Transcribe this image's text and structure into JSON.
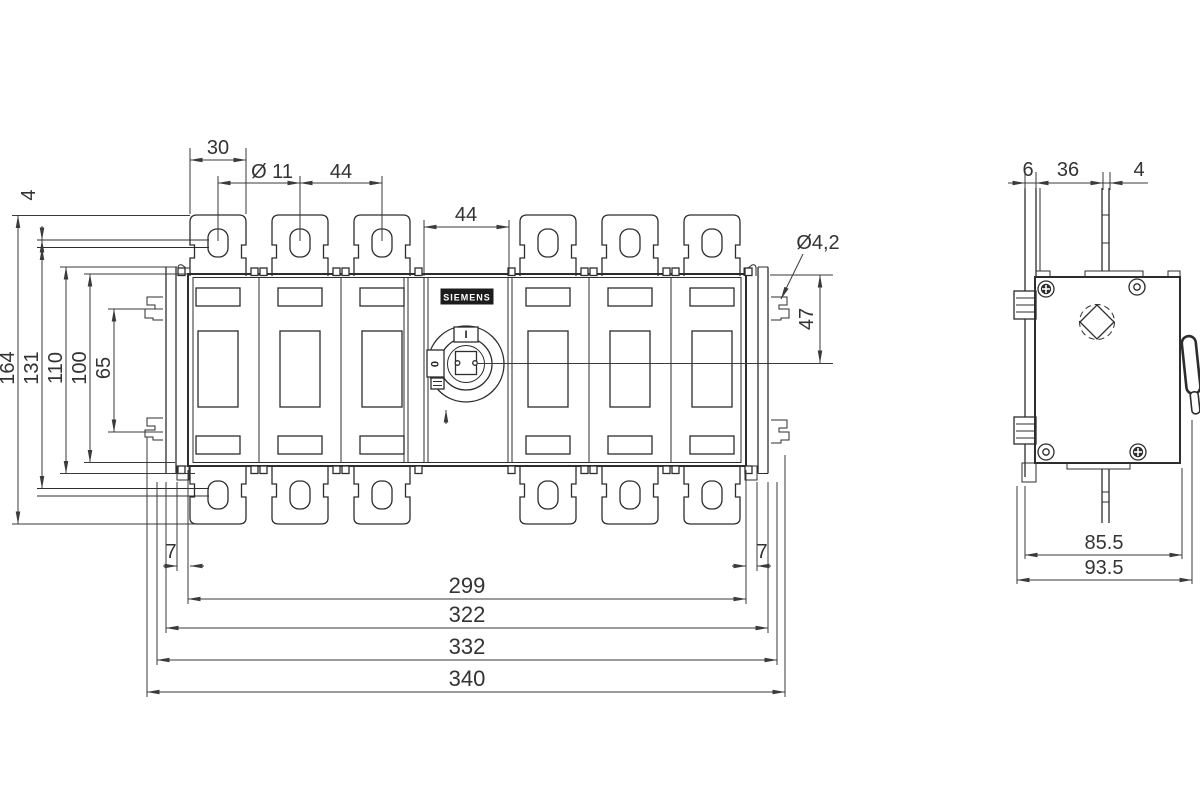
{
  "front_view": {
    "brand_label": "SIEMENS",
    "handle": {
      "on_marking": "I",
      "off_marking": "0"
    },
    "dims": {
      "tab_width": "30",
      "hole_diameter": "Ø 11",
      "pole_pitch": "44",
      "center_module_width": "44",
      "slot_diameter": "Ø4,2",
      "handle_center_offset": "47",
      "busbar_thickness": "4",
      "overall_height": "164",
      "height_131": "131",
      "height_110": "110",
      "body_height": "100",
      "height_65": "65",
      "offset_left": "7",
      "offset_right": "7",
      "width_299": "299",
      "width_322": "322",
      "width_332": "332",
      "width_340": "340"
    }
  },
  "side_view": {
    "dims": {
      "plate_thickness": "6",
      "depth_36": "36",
      "busbar_thickness": "4",
      "body_depth": "85.5",
      "total_depth": "93.5"
    }
  }
}
